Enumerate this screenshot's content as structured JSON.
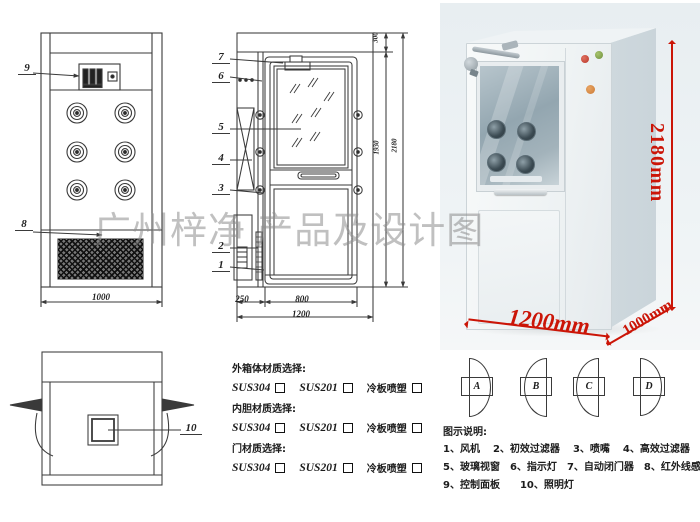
{
  "watermark": "广州梓净 产品及设计图",
  "front_view": {
    "label_9": "9",
    "label_8": "8",
    "dim_width": "1000"
  },
  "side_view": {
    "labels": {
      "l1": "1",
      "l2": "2",
      "l3": "3",
      "l4": "4",
      "l5": "5",
      "l6": "6",
      "l7": "7"
    },
    "dim_top": "300",
    "dim_inner": "1930",
    "dim_total": "2180",
    "dim_250": "250",
    "dim_800": "800",
    "dim_1200": "1200"
  },
  "top_view": {
    "label_10": "10"
  },
  "photo": {
    "dim_height": "2180mm",
    "dim_width": "1200mm",
    "dim_depth": "1000mm",
    "accent_red": "#cb1507",
    "light_red": "#b8372a",
    "light_green": "#6f8f3e",
    "light_orange": "#cb7a35"
  },
  "materials": {
    "sections": [
      {
        "title": "外箱体材质选择:",
        "opts": [
          "SUS304",
          "SUS201",
          "冷板喷塑"
        ]
      },
      {
        "title": "内胆材质选择:",
        "opts": [
          "SUS304",
          "SUS201",
          "冷板喷塑"
        ]
      },
      {
        "title": "门材质选择:",
        "opts": [
          "SUS304",
          "SUS201",
          "冷板喷塑"
        ]
      }
    ]
  },
  "door_options": {
    "a": "A",
    "b": "B",
    "c": "C",
    "d": "D"
  },
  "legend": {
    "title": "图示说明:",
    "row1": [
      "1、风机",
      "2、初效过滤器",
      "3、喷嘴",
      "4、高效过滤器"
    ],
    "row2": [
      "5、玻璃视窗",
      "6、指示灯",
      "7、自动闭门器",
      "8、红外线感应器"
    ],
    "row3": [
      "9、控制面板",
      "10、照明灯"
    ]
  }
}
